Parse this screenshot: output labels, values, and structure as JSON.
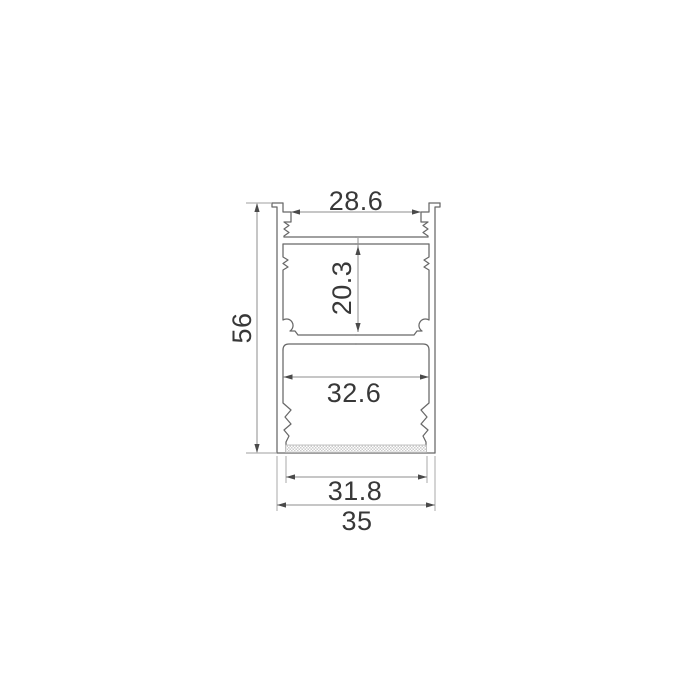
{
  "drawing": {
    "kind": "profile-cross-section-drawing",
    "background_color": "#ffffff",
    "profile_line_color": "#686868",
    "dimension_line_color": "#8c8c8c",
    "arrow_color": "#4a4a4a",
    "text_color": "#383838",
    "hatch_color": "#cccccc"
  },
  "dimensions": {
    "top_opening_width": "28.6",
    "middle_cavity_height": "20.3",
    "overall_height": "56",
    "lower_cavity_width": "32.6",
    "bottom_inner_width": "31.8",
    "overall_width": "35"
  }
}
